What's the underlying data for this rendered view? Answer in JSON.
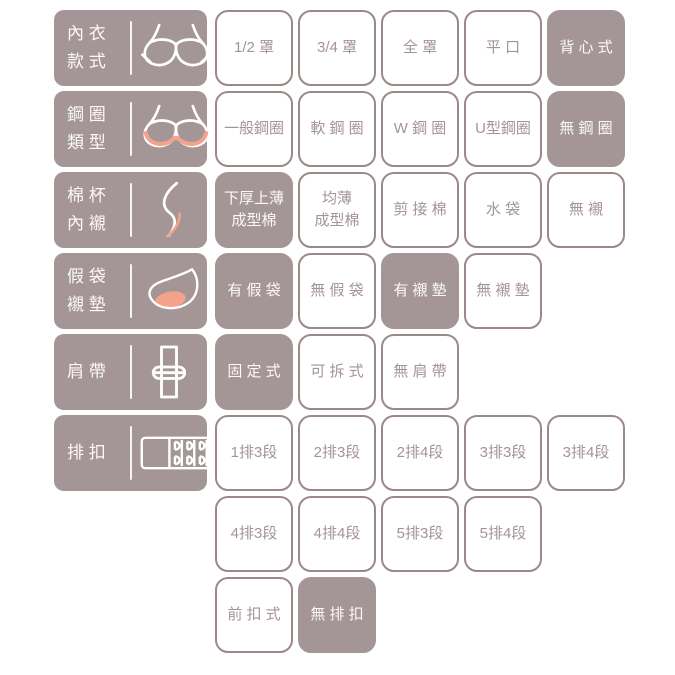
{
  "colors": {
    "mauve": "#a49696",
    "border": "#9b8989",
    "cell_text": "#a49494",
    "salmon": "#f5a28c",
    "white_text": "#fbf9f9"
  },
  "rows": [
    {
      "name": "bra-style",
      "label": "內 衣\n款 式",
      "icon": "bra-icon",
      "options": [
        {
          "label": "1/2 罩"
        },
        {
          "label": "3/4 罩"
        },
        {
          "label": "全 罩"
        },
        {
          "label": "平 口"
        },
        {
          "label": "背 心 式",
          "selected": true
        }
      ]
    },
    {
      "name": "underwire-type",
      "label": "鋼 圈\n類 型",
      "icon": "underwire-bra-icon",
      "options": [
        {
          "label": "一般鋼圈"
        },
        {
          "label": "軟 鋼 圈"
        },
        {
          "label": "W 鋼 圈"
        },
        {
          "label": "U型鋼圈"
        },
        {
          "label": "無 鋼 圈",
          "selected": true
        }
      ]
    },
    {
      "name": "cup-liner",
      "label": "棉 杯\n內 襯",
      "icon": "cup-liner-icon",
      "options": [
        {
          "label": "下厚上薄\n成型棉",
          "selected": true
        },
        {
          "label": "均薄\n成型棉"
        },
        {
          "label": "剪 接 棉"
        },
        {
          "label": "水 袋"
        },
        {
          "label": "無 襯"
        }
      ]
    },
    {
      "name": "pad-pocket",
      "label": "假 袋\n襯 墊",
      "icon": "pad-icon",
      "options": [
        {
          "label": "有 假 袋",
          "selected": true
        },
        {
          "label": "無 假 袋"
        },
        {
          "label": "有 襯 墊",
          "selected": true
        },
        {
          "label": "無 襯 墊"
        }
      ]
    },
    {
      "name": "shoulder-strap",
      "label": "肩 帶",
      "icon": "strap-icon",
      "options": [
        {
          "label": "固 定 式",
          "selected": true
        },
        {
          "label": "可 拆 式"
        },
        {
          "label": "無 肩 帶"
        }
      ]
    },
    {
      "name": "hook-rows",
      "label": "排 扣",
      "icon": "hook-closure-icon",
      "options": [
        {
          "label": "1排3段"
        },
        {
          "label": "2排3段"
        },
        {
          "label": "2排4段"
        },
        {
          "label": "3排3段"
        },
        {
          "label": "3排4段"
        }
      ]
    },
    {
      "name": "hook-rows-2",
      "label": null,
      "options": [
        {
          "label": "4排3段"
        },
        {
          "label": "4排4段"
        },
        {
          "label": "5排3段"
        },
        {
          "label": "5排4段"
        }
      ]
    },
    {
      "name": "hook-rows-3",
      "label": null,
      "options": [
        {
          "label": "前 扣 式"
        },
        {
          "label": "無 排 扣",
          "selected": true
        }
      ]
    }
  ]
}
